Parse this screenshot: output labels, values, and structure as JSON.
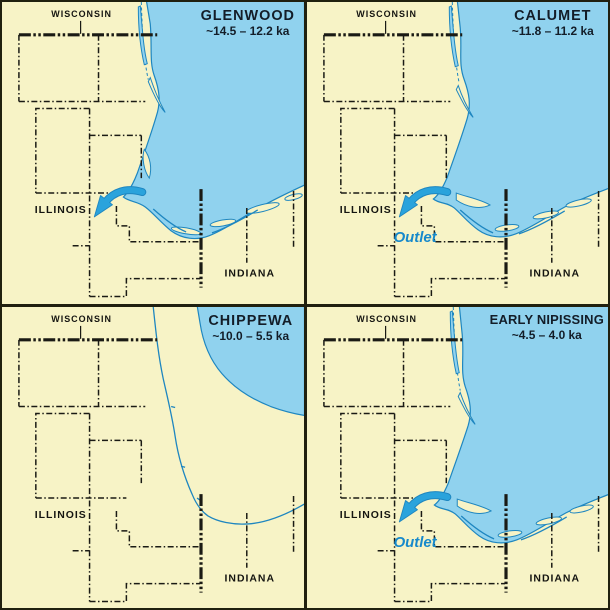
{
  "labels": {
    "wisconsin": "WISCONSIN",
    "illinois": "ILLINOIS",
    "indiana": "INDIANA"
  },
  "panels": [
    {
      "title": "GLENWOOD",
      "age": "~14.5 – 12.2 ka",
      "outlet": ""
    },
    {
      "title": "CALUMET",
      "age": "~11.8 – 11.2 ka",
      "outlet": "Outlet"
    },
    {
      "title": "CHIPPEWA",
      "age": "~10.0 – 5.5 ka",
      "outlet": ""
    },
    {
      "title": "EARLY NIPISSING",
      "age": "~4.5 – 4.0 ka",
      "outlet": "Outlet"
    }
  ],
  "colors": {
    "land": "#F7F3C6",
    "lake": "#90D2EE",
    "shore": "#1E86C0",
    "boundary_line": "#1A1A14",
    "frame": "#20200F",
    "arrow": "#2AA3DC",
    "outlet_text": "#1789CB",
    "title_text": "#131D28"
  }
}
